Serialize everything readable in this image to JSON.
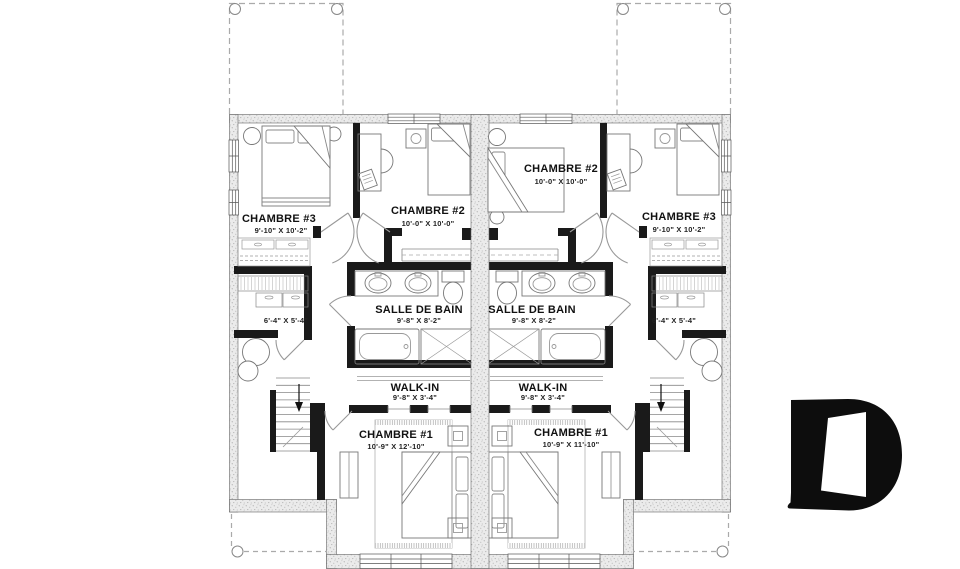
{
  "plan": {
    "left_unit": {
      "chambre_3": {
        "label": "CHAMBRE #3",
        "dims": "9'-10\" X 10'-2\""
      },
      "chambre_2": {
        "label": "CHAMBRE #2",
        "dims": "10'-0\" X 10'-0\""
      },
      "salle_de_bain": {
        "label": "SALLE DE BAIN",
        "dims": "9'-8\" X 8'-2\""
      },
      "rangement": {
        "dims": "6'-4\" X 5'-4\""
      },
      "walk_in": {
        "label": "WALK-IN",
        "dims": "9'-8\" X 3'-4\""
      },
      "chambre_1": {
        "label": "CHAMBRE #1",
        "dims": "10'-9\" X 12'-10\""
      }
    },
    "right_unit": {
      "chambre_2": {
        "label": "CHAMBRE #2",
        "dims": "10'-0\" X 10'-0\""
      },
      "chambre_3": {
        "label": "CHAMBRE #3",
        "dims": "9'-10\" X 10'-2\""
      },
      "salle_de_bain": {
        "label": "SALLE DE BAIN",
        "dims": "9'-8\" X 8'-2\""
      },
      "rangement": {
        "dims": "6'-4\" X 5'-4\""
      },
      "walk_in": {
        "label": "WALK-IN",
        "dims": "9'-8\" X 3'-4\""
      },
      "chambre_1": {
        "label": "CHAMBRE #1",
        "dims": "10'-9\" X 11'-10\""
      }
    }
  },
  "watermark": {
    "icon": "letter-d-door-logo"
  },
  "colors": {
    "wall_black": "#1a1a1a",
    "stipple_base": "#ebebeb",
    "line_gray": "#888888",
    "door_gray": "#999999",
    "dashed_gray": "#aaaaaa",
    "logo": "#0d0d0d",
    "text": "#111111"
  }
}
